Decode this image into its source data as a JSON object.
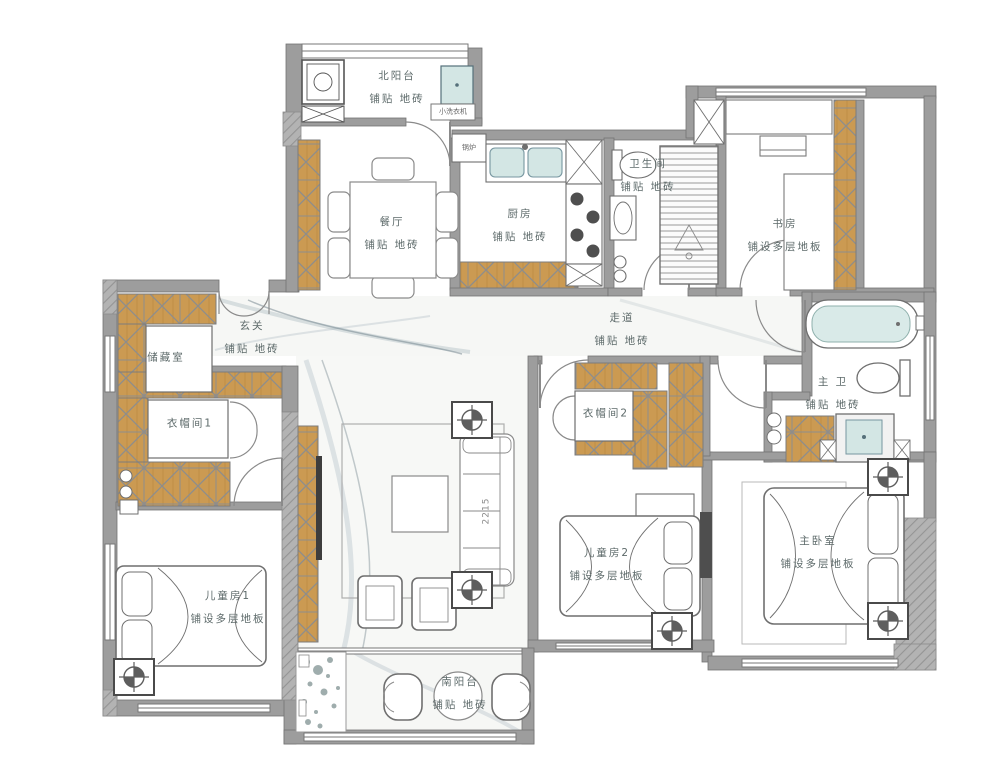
{
  "rooms": {
    "north_balcony": {
      "name": "北阳台",
      "floor": "铺贴 地砖"
    },
    "dining": {
      "name": "餐厅",
      "floor": "铺贴 地砖"
    },
    "kitchen": {
      "name": "厨房",
      "floor": "铺贴 地砖"
    },
    "bathroom": {
      "name": "卫生间",
      "floor": "铺贴 地砖"
    },
    "study": {
      "name": "书房",
      "floor": "铺设多层地板"
    },
    "entry": {
      "name": "玄关",
      "floor": "铺贴 地砖"
    },
    "corridor": {
      "name": "走道",
      "floor": "铺贴 地砖"
    },
    "storage": {
      "name": "储藏室"
    },
    "cloakroom1": {
      "name": "衣帽间1"
    },
    "cloakroom2": {
      "name": "衣帽间2"
    },
    "master_bath": {
      "name": "主 卫",
      "floor": "铺贴 地砖"
    },
    "child1": {
      "name": "儿童房1",
      "floor": "铺设多层地板"
    },
    "child2": {
      "name": "儿童房2",
      "floor": "铺设多层地板"
    },
    "master_bedroom": {
      "name": "主卧室",
      "floor": "铺设多层地板"
    },
    "south_balcony": {
      "name": "南阳台",
      "floor": "铺贴 地砖"
    }
  },
  "annotations": {
    "washer_label": "小洗衣机",
    "boiler_label": "锅炉",
    "sofa_width": "2215"
  },
  "colors": {
    "wood": "#cb9a52",
    "wall": "#9d9d9d",
    "fixture_blue": "#d3e6e4"
  }
}
